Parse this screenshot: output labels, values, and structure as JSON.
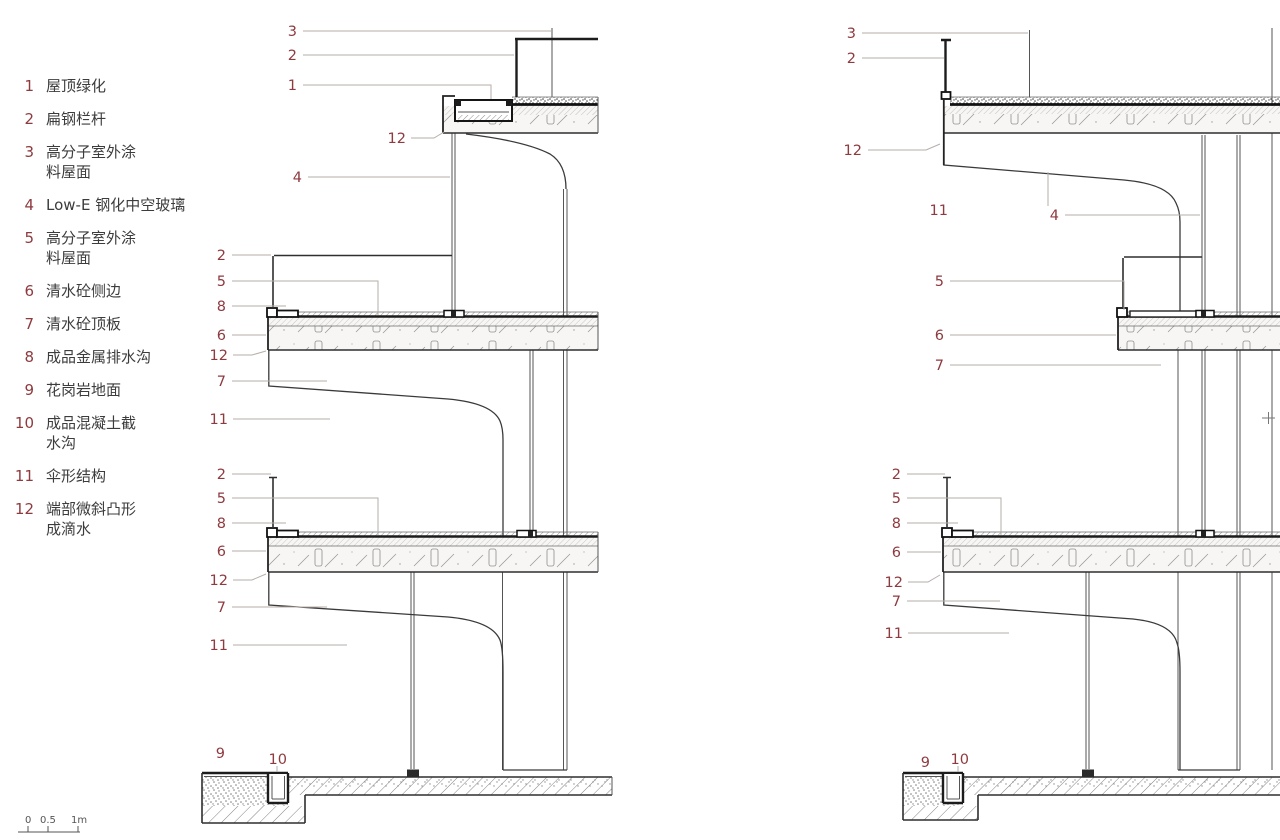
{
  "colors": {
    "accent": "#8e3a3e",
    "leader": "#b5aeaa",
    "ink": "#1c1c1c",
    "text": "#3c3c3c"
  },
  "legend": {
    "items": [
      {
        "n": "1",
        "lines": [
          "屋顶绿化"
        ]
      },
      {
        "n": "2",
        "lines": [
          "扁钢栏杆"
        ]
      },
      {
        "n": "3",
        "lines": [
          "高分子室外涂",
          "料屋面"
        ]
      },
      {
        "n": "4",
        "lines": [
          "Low-E 钢化中空玻璃"
        ]
      },
      {
        "n": "5",
        "lines": [
          "高分子室外涂",
          "料屋面"
        ]
      },
      {
        "n": "6",
        "lines": [
          "清水砼侧边"
        ]
      },
      {
        "n": "7",
        "lines": [
          "清水砼顶板"
        ]
      },
      {
        "n": "8",
        "lines": [
          "成品金属排水沟"
        ]
      },
      {
        "n": "9",
        "lines": [
          "花岗岩地面"
        ]
      },
      {
        "n": "10",
        "lines": [
          "成品混凝土截",
          "水沟"
        ]
      },
      {
        "n": "11",
        "lines": [
          "伞形结构"
        ]
      },
      {
        "n": "12",
        "lines": [
          "端部微斜凸形",
          "成滴水"
        ]
      }
    ]
  },
  "scale_bar": {
    "labels": [
      "0",
      "0.5",
      "1m"
    ]
  },
  "details": {
    "left": {
      "callouts": [
        {
          "n": "3",
          "tx": 297,
          "ty": 36,
          "leader": [
            [
              303,
              31
            ],
            [
              551,
              31
            ]
          ]
        },
        {
          "n": "2",
          "tx": 297,
          "ty": 60,
          "leader": [
            [
              303,
              55
            ],
            [
              514,
              55
            ]
          ]
        },
        {
          "n": "1",
          "tx": 297,
          "ty": 90,
          "leader": [
            [
              303,
              85
            ],
            [
              491,
              85
            ],
            [
              491,
              99
            ]
          ]
        },
        {
          "n": "12",
          "tx": 406,
          "ty": 143,
          "leader": [
            [
              411,
              138
            ],
            [
              434,
              138
            ],
            [
              444,
              132
            ]
          ]
        },
        {
          "n": "4",
          "tx": 302,
          "ty": 182,
          "leader": [
            [
              308,
              177
            ],
            [
              450,
              177
            ]
          ]
        },
        {
          "n": "2",
          "tx": 226,
          "ty": 260,
          "leader": [
            [
              232,
              255
            ],
            [
              271,
              255
            ]
          ]
        },
        {
          "n": "5",
          "tx": 226,
          "ty": 286,
          "leader": [
            [
              232,
              281
            ],
            [
              378,
              281
            ],
            [
              378,
              315
            ]
          ]
        },
        {
          "n": "8",
          "tx": 226,
          "ty": 311,
          "leader": [
            [
              232,
              306
            ],
            [
              286,
              306
            ]
          ]
        },
        {
          "n": "6",
          "tx": 226,
          "ty": 340,
          "leader": [
            [
              232,
              335
            ],
            [
              266,
              335
            ]
          ]
        },
        {
          "n": "12",
          "tx": 228,
          "ty": 360,
          "leader": [
            [
              233,
              355
            ],
            [
              252,
              355
            ],
            [
              266,
              351
            ]
          ]
        },
        {
          "n": "7",
          "tx": 226,
          "ty": 386,
          "leader": [
            [
              232,
              381
            ],
            [
              327,
              381
            ]
          ]
        },
        {
          "n": "11",
          "tx": 228,
          "ty": 424,
          "leader": [
            [
              233,
              419
            ],
            [
              330,
              419
            ]
          ]
        },
        {
          "n": "2",
          "tx": 226,
          "ty": 479,
          "leader": [
            [
              232,
              474
            ],
            [
              271,
              474
            ]
          ]
        },
        {
          "n": "5",
          "tx": 226,
          "ty": 503,
          "leader": [
            [
              232,
              498
            ],
            [
              378,
              498
            ],
            [
              378,
              535
            ]
          ]
        },
        {
          "n": "8",
          "tx": 226,
          "ty": 528,
          "leader": [
            [
              232,
              523
            ],
            [
              286,
              523
            ]
          ]
        },
        {
          "n": "6",
          "tx": 226,
          "ty": 556,
          "leader": [
            [
              232,
              551
            ],
            [
              266,
              551
            ]
          ]
        },
        {
          "n": "12",
          "tx": 228,
          "ty": 585,
          "leader": [
            [
              233,
              580
            ],
            [
              252,
              580
            ],
            [
              266,
              574
            ]
          ]
        },
        {
          "n": "7",
          "tx": 226,
          "ty": 612,
          "leader": [
            [
              232,
              607
            ],
            [
              327,
              607
            ]
          ]
        },
        {
          "n": "11",
          "tx": 228,
          "ty": 650,
          "leader": [
            [
              233,
              645
            ],
            [
              347,
              645
            ]
          ]
        },
        {
          "n": "9",
          "tx": 225,
          "ty": 758,
          "leader": []
        },
        {
          "n": "10",
          "tx": 287,
          "ty": 764,
          "leader": [
            [
              277,
              766
            ],
            [
              277,
              772
            ]
          ]
        }
      ]
    },
    "right": {
      "callouts": [
        {
          "n": "3",
          "tx": 856,
          "ty": 38,
          "leader": [
            [
              862,
              33
            ],
            [
              1028,
              33
            ]
          ]
        },
        {
          "n": "2",
          "tx": 856,
          "ty": 63,
          "leader": [
            [
              862,
              58
            ],
            [
              944,
              58
            ]
          ]
        },
        {
          "n": "12",
          "tx": 862,
          "ty": 155,
          "leader": [
            [
              868,
              150
            ],
            [
              926,
              150
            ],
            [
              940,
              144
            ]
          ]
        },
        {
          "n": "11",
          "tx": 948,
          "ty": 215,
          "leader": [
            [
              1048,
              206
            ],
            [
              1048,
              172
            ]
          ]
        },
        {
          "n": "4",
          "tx": 1059,
          "ty": 220,
          "leader": [
            [
              1065,
              215
            ],
            [
              1200,
              215
            ]
          ]
        },
        {
          "n": "5",
          "tx": 944,
          "ty": 286,
          "leader": [
            [
              950,
              281
            ],
            [
              1124,
              281
            ],
            [
              1124,
              310
            ]
          ]
        },
        {
          "n": "6",
          "tx": 944,
          "ty": 340,
          "leader": [
            [
              950,
              335
            ],
            [
              1116,
              335
            ]
          ]
        },
        {
          "n": "7",
          "tx": 944,
          "ty": 370,
          "leader": [
            [
              950,
              365
            ],
            [
              1161,
              365
            ]
          ]
        },
        {
          "n": "2",
          "tx": 901,
          "ty": 479,
          "leader": [
            [
              907,
              474
            ],
            [
              945,
              474
            ]
          ]
        },
        {
          "n": "5",
          "tx": 901,
          "ty": 503,
          "leader": [
            [
              907,
              498
            ],
            [
              1001,
              498
            ],
            [
              1001,
              535
            ]
          ]
        },
        {
          "n": "8",
          "tx": 901,
          "ty": 528,
          "leader": [
            [
              907,
              523
            ],
            [
              958,
              523
            ]
          ]
        },
        {
          "n": "6",
          "tx": 901,
          "ty": 557,
          "leader": [
            [
              907,
              552
            ],
            [
              941,
              552
            ]
          ]
        },
        {
          "n": "12",
          "tx": 903,
          "ty": 587,
          "leader": [
            [
              908,
              582
            ],
            [
              928,
              582
            ],
            [
              940,
              575
            ]
          ]
        },
        {
          "n": "7",
          "tx": 901,
          "ty": 606,
          "leader": [
            [
              907,
              601
            ],
            [
              1000,
              601
            ]
          ]
        },
        {
          "n": "11",
          "tx": 903,
          "ty": 638,
          "leader": [
            [
              908,
              633
            ],
            [
              1009,
              633
            ]
          ]
        },
        {
          "n": "9",
          "tx": 930,
          "ty": 767,
          "leader": []
        },
        {
          "n": "10",
          "tx": 969,
          "ty": 764,
          "leader": [
            [
              958,
              766
            ],
            [
              958,
              772
            ]
          ]
        }
      ]
    }
  }
}
